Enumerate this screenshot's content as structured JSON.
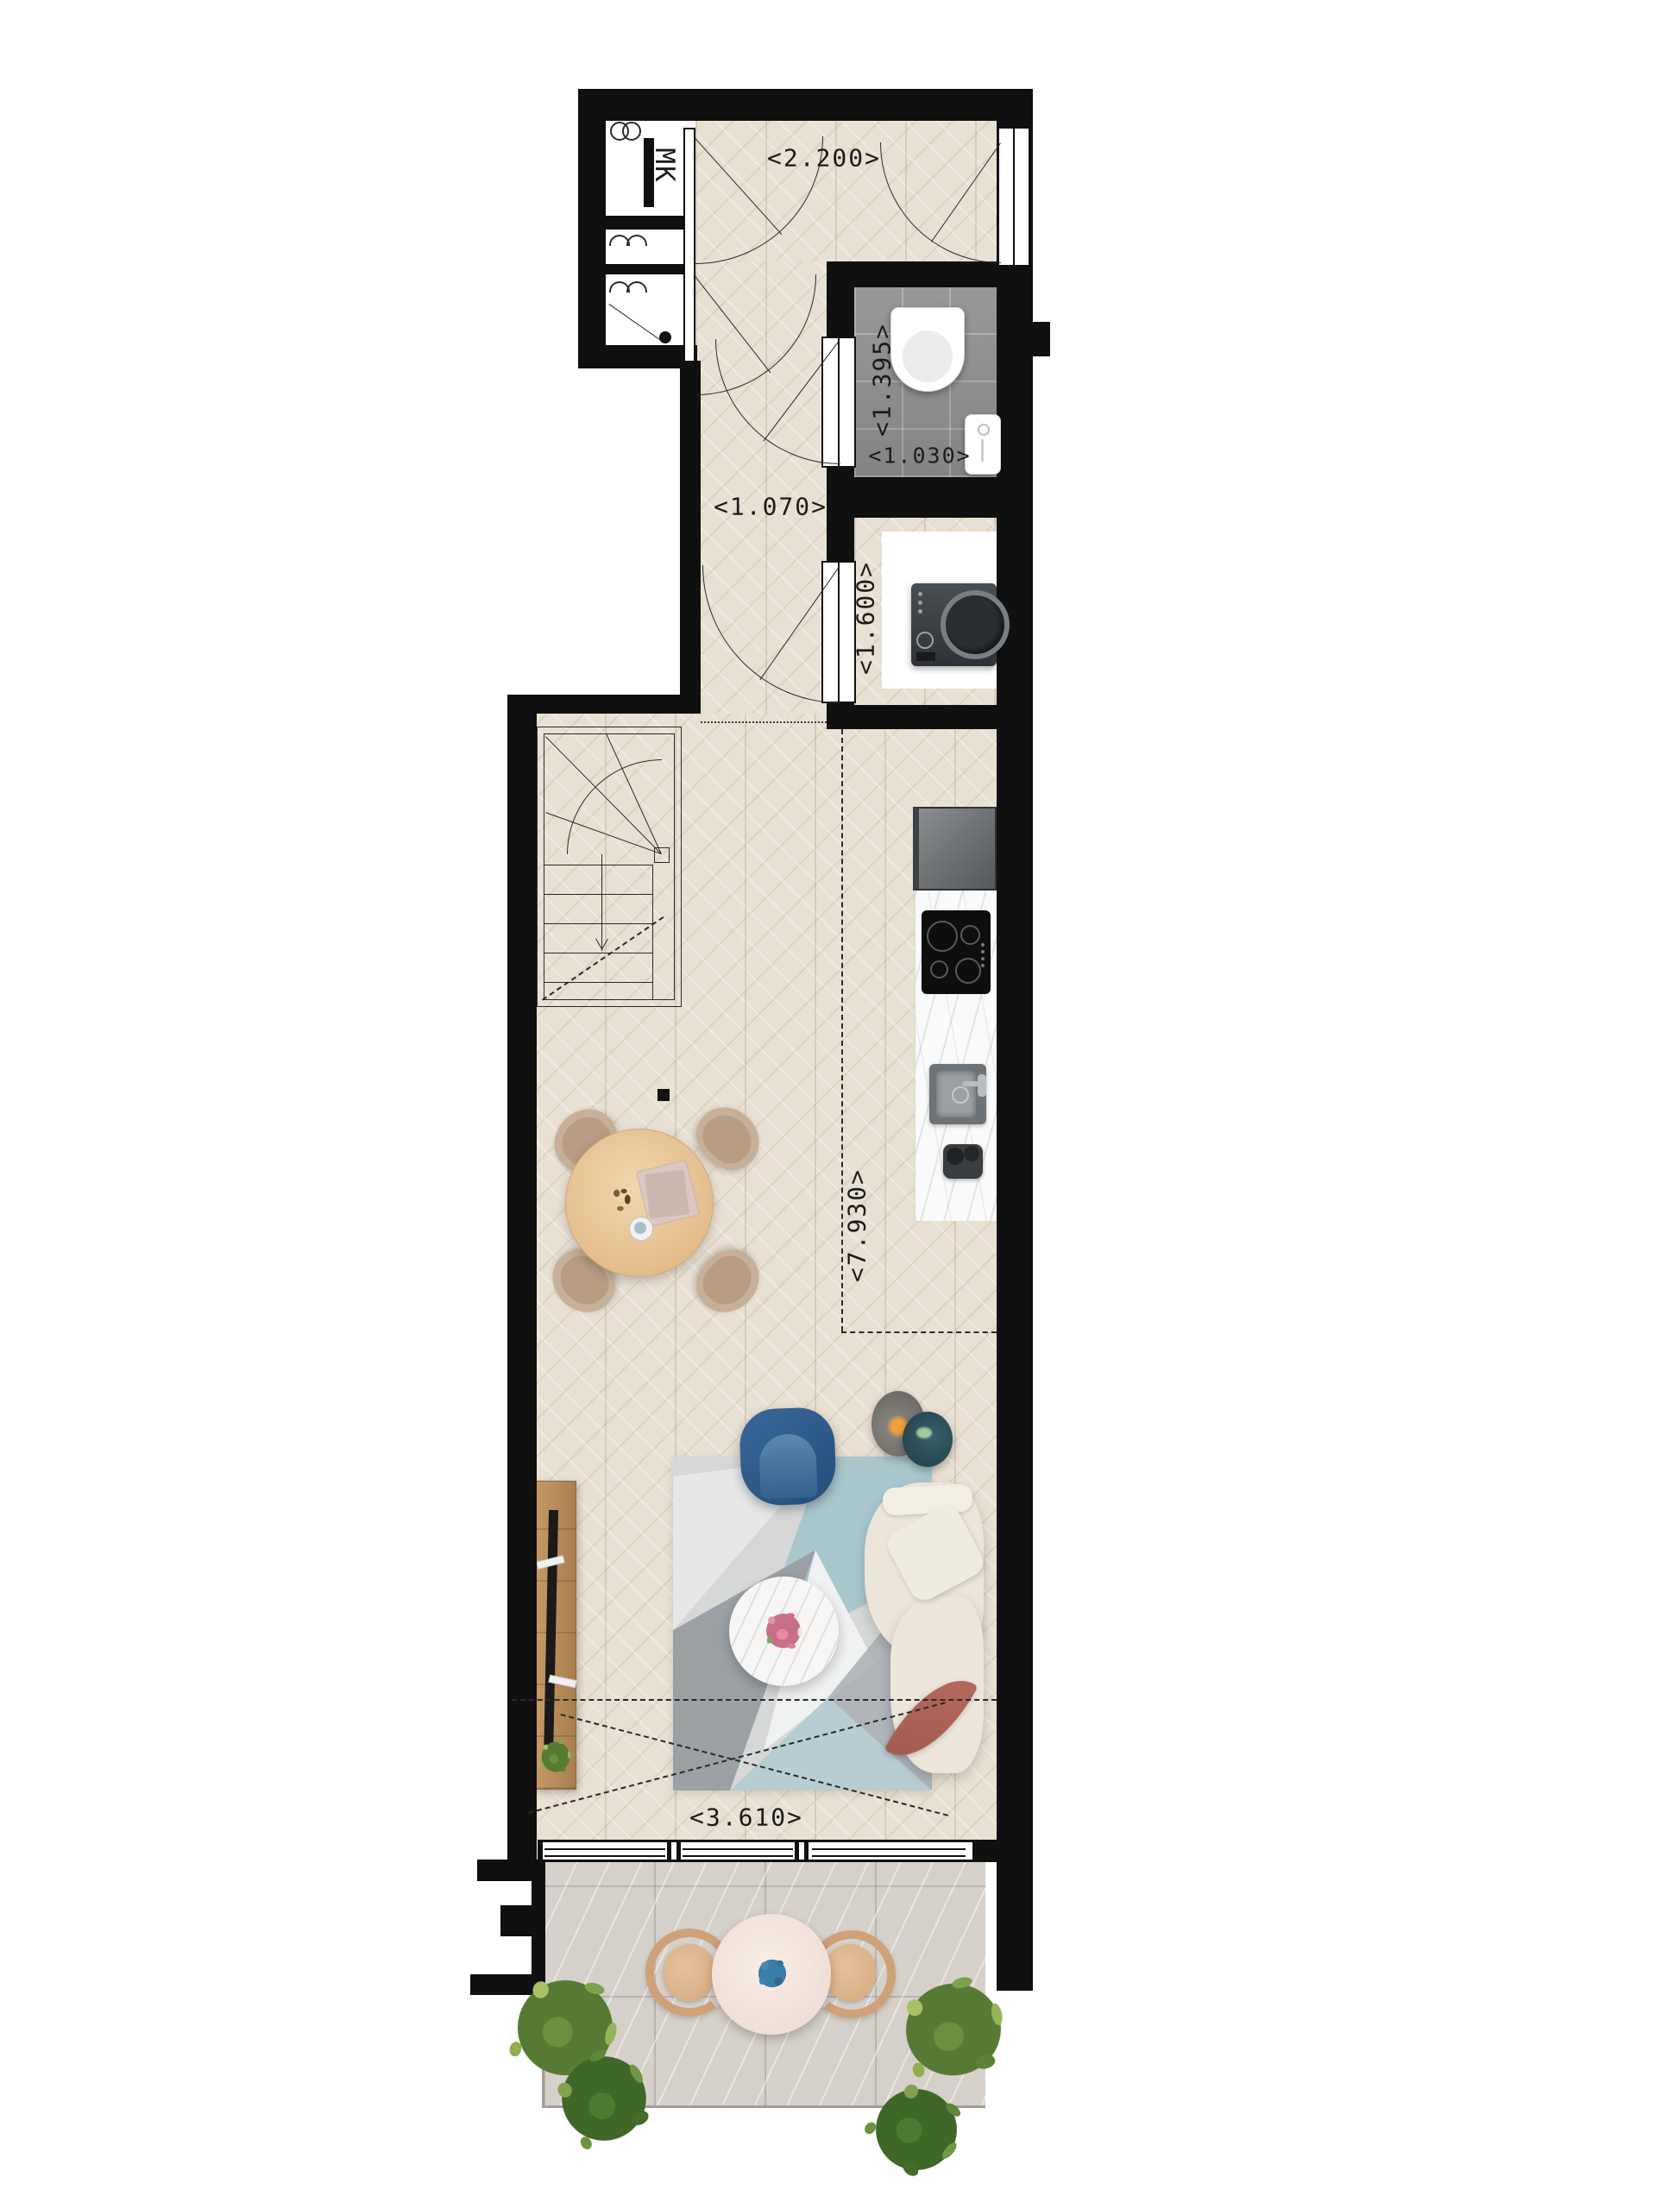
{
  "plan": {
    "type": "apartment-floor-plan",
    "labels": {
      "meter_closet": "MK",
      "entry_width": "<2.200>",
      "wc_depth": "<1.395>",
      "wc_width": "<1.030>",
      "hall_width": "<1.070>",
      "laundry_width": "<1.600>",
      "living_length": "<7.930>",
      "living_width": "<3.610>"
    },
    "colors": {
      "wall": "#101010",
      "wood_floor": "#e8e0d2",
      "wc_tile": "#8c8c8c",
      "balcony_tile": "#d6d0ca",
      "counter_marble": "#fafafa",
      "armchair_blue": "#2f5d8a",
      "rug_teal": "#a9c6cd",
      "sofa_cream": "#ece5d9",
      "cushion_rose": "#b4675c",
      "dining_wood": "#e9c697",
      "plant_green": "#6c8f3f",
      "drawing_line": "#2b2b2b"
    },
    "fixtures": [
      "toilet",
      "hand-basin",
      "washing-machine",
      "fridge",
      "induction-cooktop",
      "kitchen-sink",
      "coffee-machine",
      "winder-stairs",
      "dining-table",
      "blue-armchair",
      "floor-lamp",
      "sofa",
      "coffee-table",
      "tv-sideboard",
      "balcony-table",
      "balcony-chairs",
      "outdoor-plants"
    ]
  }
}
